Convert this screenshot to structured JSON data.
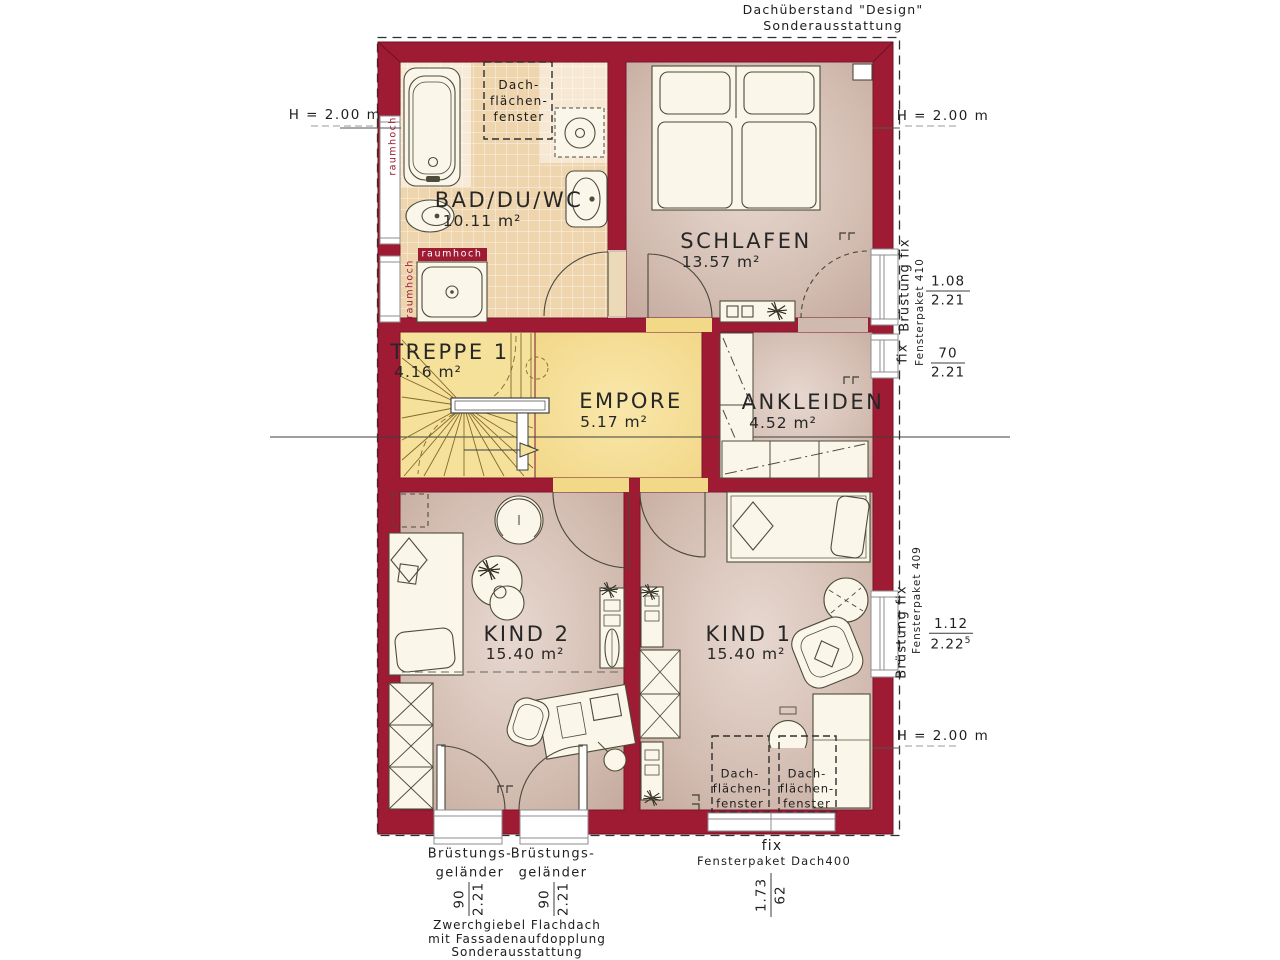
{
  "colors": {
    "wall": "#9e1b33",
    "tile": "#eed5ae",
    "floor": "#d5bfb4",
    "empore": "#f4dc8e",
    "furniture": "#faf7ea"
  },
  "notes": {
    "roof_top": [
      "Dachüberstand \"Design\"",
      "Sonderausstattung"
    ],
    "roof_bottom": [
      "Zwerchgiebel Flachdach",
      "mit Fassadenaufdopplung",
      "Sonderausstattung"
    ]
  },
  "heights": {
    "left": "H = 2.00 m",
    "right_top": "H = 2.00 m",
    "right_bottom": "H = 2.00 m"
  },
  "rooms": {
    "bad": {
      "name": "BAD/DU/WC",
      "area": "10.11 m²"
    },
    "schlafen": {
      "name": "SCHLAFEN",
      "area": "13.57 m²"
    },
    "treppe": {
      "name": "TREPPE 1",
      "area": "4.16 m²"
    },
    "empore": {
      "name": "EMPORE",
      "area": "5.17 m²"
    },
    "ankleiden": {
      "name": "ANKLEIDEN",
      "area": "4.52 m²"
    },
    "kind2": {
      "name": "KIND 2",
      "area": "15.40 m²"
    },
    "kind1": {
      "name": "KIND 1",
      "area": "15.40 m²"
    }
  },
  "roof_window_label": [
    "Dach-",
    "flächen-",
    "fenster"
  ],
  "raumhoch": "raumhoch",
  "right": {
    "win410": {
      "brustung": "Brüstung fix",
      "paket": "Fensterpaket 410",
      "frac1_num": "1.08",
      "frac1_den": "2.21",
      "fix": "fix",
      "frac2_num": "70",
      "frac2_den": "2.21"
    },
    "win409": {
      "brustung": "Brüstung fix",
      "paket": "Fensterpaket 409",
      "frac_num": "1.12",
      "frac_den": "2.22",
      "frac_den_sup": "5"
    }
  },
  "bottom": {
    "balcony": {
      "line1": "Brüstungs-",
      "line2": "geländer",
      "frac_num": "90",
      "frac_den": "2.21"
    },
    "dach400": {
      "fix": "fix",
      "paket": "Fensterpaket Dach400",
      "frac_num": "1.73",
      "frac_den": "62"
    }
  }
}
